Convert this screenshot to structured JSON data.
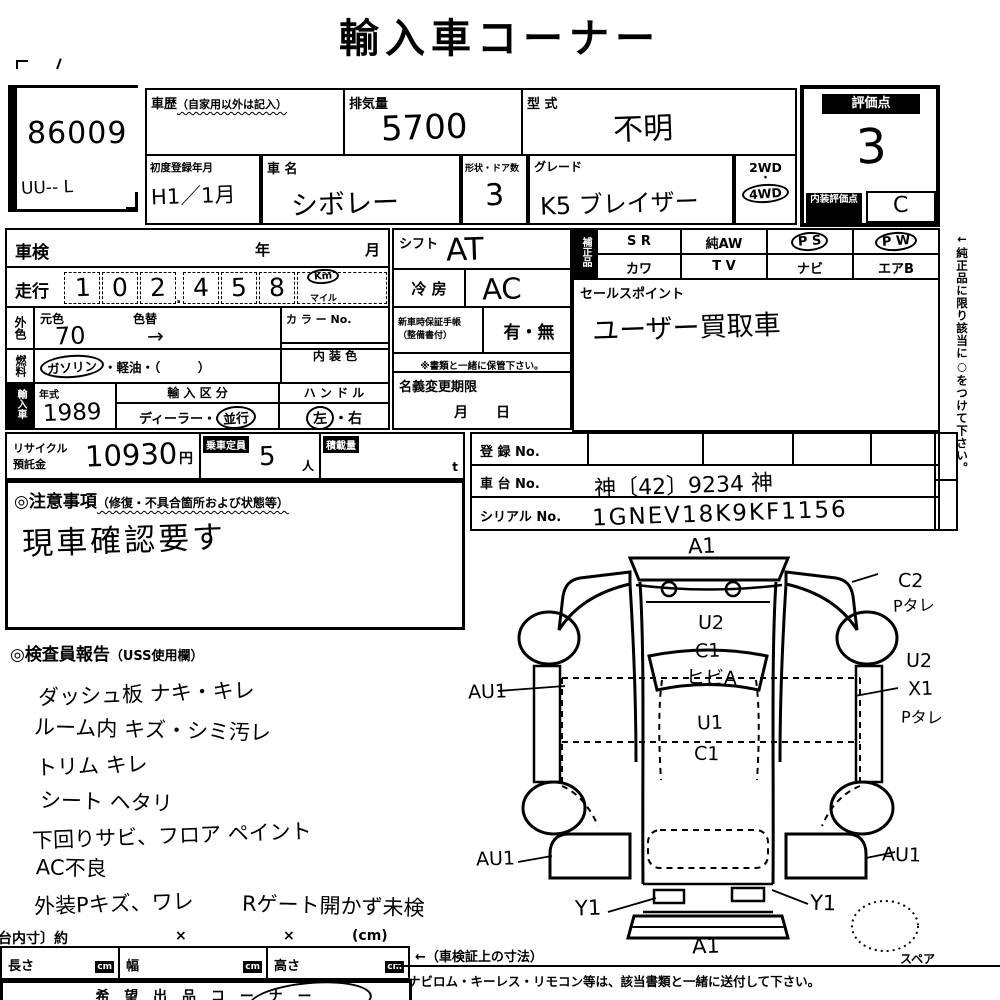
{
  "title": "輸入車コーナー",
  "lot": {
    "number": "86009",
    "note": "UU--  L"
  },
  "top": {
    "history_label": "車歴",
    "history_sub": "（自家用以外は記入）",
    "displacement_label": "排気量",
    "displacement_value": "5700",
    "model_label": "型 式",
    "model_value": "不明",
    "first_reg_label": "初度登録年月",
    "first_reg_value": "H1／1月",
    "name_label": "車 名",
    "name_value": "シボレー",
    "shape_label": "形状・ドア数",
    "shape_value": "3",
    "grade_label": "グレード",
    "grade_value": "K5 ブレイザー",
    "drive_top": "2WD",
    "drive_sep": "・",
    "drive_bottom": "4WD",
    "score_label": "評価点",
    "score_value": "3",
    "interior_score_label": "内装評価点",
    "interior_score_value": "C"
  },
  "left": {
    "shaken_label": "車検",
    "shaken_year": "年",
    "shaken_month": "月",
    "mileage_label": "走行",
    "mileage_digits": [
      "1",
      "0",
      "2",
      "4",
      "5",
      "8"
    ],
    "mileage_point": ".",
    "unit_km": "Km",
    "unit_mile": "マイル",
    "ext_color_label": "外色",
    "base_color_label": "元色",
    "base_color_value": "70",
    "repaint_label": "色替",
    "repaint_value": "→",
    "color_no_label": "カ ラ ー No.",
    "fuel_label": "燃料",
    "fuel_value": "ガソリン",
    "fuel_rest": "・軽油・（　　　）",
    "interior_color_label": "内 装 色",
    "group_label": "輸入車",
    "year_label": "年式",
    "year_value": "1989",
    "import_label": "輸 入 区 分",
    "import_dealer": "ディーラー",
    "import_sep": "・",
    "import_parallel": "並行",
    "handle_label": "ハ ン ド ル",
    "handle_left": "左",
    "handle_sep": "・",
    "handle_right": "右"
  },
  "mid": {
    "shift_label": "シフト",
    "shift_value": "AT",
    "ac_label": "冷 房",
    "ac_value": "AC",
    "warranty_label1": "新車時保証手帳",
    "warranty_label2": "（整備書付）",
    "warranty_value": "有・無",
    "warranty_note": "※書類と一緒に保管下さい。",
    "name_change_label": "名義変更期限",
    "name_change_value": "月　　日"
  },
  "equip": {
    "label": "補正品",
    "r1c1": "S R",
    "r1c2": "純AW",
    "r1c3": "P S",
    "r1c4": "P W",
    "r2c1": "カワ",
    "r2c2": "T V",
    "r2c3": "ナビ",
    "r2c4": "エアB"
  },
  "sales": {
    "label": "セールスポイント",
    "value": "ユーザー買取車"
  },
  "side_note": "←純正品に限り該当に○をつけて下さい。",
  "reg": {
    "reg_label": "登 録 No.",
    "chassis_label": "車 台 No.",
    "chassis_value": "神〔42〕9234 神",
    "serial_label": "シリアル No.",
    "serial_value": "1GNEV18K9KF1156"
  },
  "recycle": {
    "label1": "リサイクル",
    "label2": "預託金",
    "value": "10930",
    "yen": "円",
    "capacity_label": "乗車定員",
    "capacity_value": "5",
    "capacity_unit": "人",
    "load_label": "積載量",
    "load_unit": "t"
  },
  "caution": {
    "header": "◎注意事項",
    "header_sub": "（修復・不具合箇所および状態等）",
    "note": "現車確認要す"
  },
  "report": {
    "header": "◎検査員報告",
    "header_sub": "（USS使用欄）",
    "lines": [
      "ダッシュ板 ナキ・キレ",
      "ルーム内 キズ・シミ汚レ",
      "トリム キレ",
      "シート ヘタリ",
      "下回りサビ、フロア ペイント",
      "AC不良",
      "外装Pキズ、ワレ"
    ],
    "extra": "Rゲート開かず未検"
  },
  "dims": {
    "header": "〔荷台内寸〕約",
    "x1": "×",
    "x2": "×",
    "unit_paren": "(cm)",
    "length_label": "長さ",
    "width_label": "幅",
    "height_label": "高さ",
    "cm": "cm",
    "cert_note": "←（車検証上の寸法）",
    "corner_label": "希 望 出 品 コ ー ナ ー"
  },
  "diagram": {
    "a1_front": "A1",
    "u2_hood": "U2",
    "c1_hood": "C1",
    "crack": "ヒビA",
    "u1_roof": "U1",
    "c1_roof": "C1",
    "au1_left_front": "AU1",
    "c2_right": "C2",
    "ptare_right_top": "Pタレ",
    "u2_right": "U2",
    "x1_right": "X1",
    "ptare_right_mid": "Pタレ",
    "au1_left_rear": "AU1",
    "au1_right_rear": "AU1",
    "y1_left": "Y1",
    "y1_right": "Y1",
    "a1_rear": "A1",
    "spare_label": "スペア"
  },
  "footer": "ナビロム・キーレス・リモコン等は、該当書類と一緒に送付して下さい。"
}
